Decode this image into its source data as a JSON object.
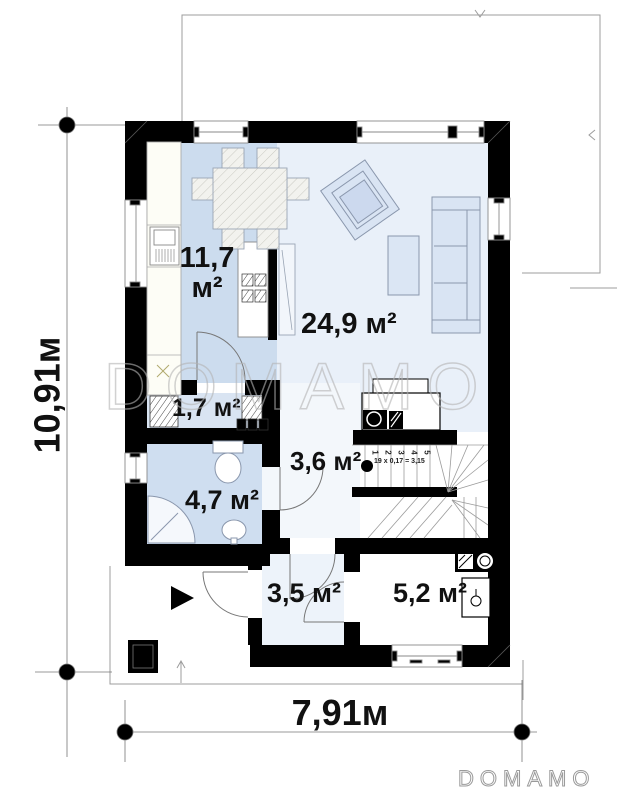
{
  "brand": {
    "watermark": "DOMAMO",
    "logo": "DOMAMO"
  },
  "dimensions": {
    "height_label": "10,91м",
    "width_label": "7,91м"
  },
  "rooms": {
    "kitchen": {
      "value": "11,7",
      "unit": "м²"
    },
    "living": {
      "label": "24,9 м²"
    },
    "closet": {
      "label": "1,7 м²"
    },
    "hall": {
      "label": "3,6 м²"
    },
    "bath": {
      "label": "4,7 м²"
    },
    "vestibule": {
      "label": "3,5 м²"
    },
    "utility": {
      "label": "5,2 м²"
    }
  },
  "stairs": {
    "formula": "19 x 0,17 = 3,15",
    "steps": [
      "1",
      "2",
      "3",
      "4",
      "5"
    ]
  },
  "colors": {
    "wall": "#000000",
    "kitchen_fill": "#ccdcee",
    "living_fill": "#e9f0f9",
    "bath_fill": "#cfdef0",
    "closet_fill": "#d9e4f2",
    "vestibule_fill": "#edf3fa",
    "furniture_fill": "#d9e4f3",
    "line_gray": "#999999"
  }
}
